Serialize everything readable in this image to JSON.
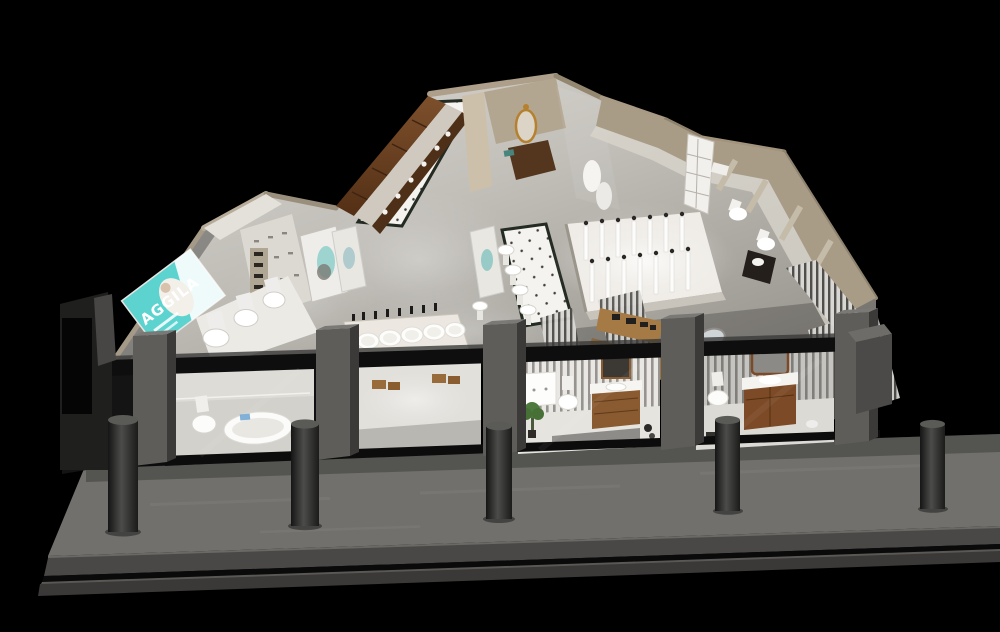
{
  "scene": {
    "title": "Sanitary-ware showroom - aerial cutaway 3D render",
    "style": "night render on black surround, bird's-eye isometric view",
    "background_color": "#000000"
  },
  "billboard": {
    "brand": "AGGILA",
    "panel_color": "#5dd3d0",
    "text_color": "#ffffff",
    "location": "left showroom wall lightbox"
  },
  "zones": [
    {
      "id": "wood-cabinet-wall",
      "label": "dark wood cabinet display wall"
    },
    {
      "id": "dotted-tile-walkway",
      "label": "white dotted tile walkway with dark green border"
    },
    {
      "id": "toilet-display-row-left",
      "label": "toilet display row on white plinth",
      "fixture_count": 3
    },
    {
      "id": "faucet-display-shelving",
      "label": "white faucet display shelving with lightbox"
    },
    {
      "id": "basin-display-table",
      "label": "illuminated countertop basin table",
      "basin_count": 5
    },
    {
      "id": "pedestal-basin-row",
      "label": "pedestal basins along walkway",
      "fixture_count": 5
    },
    {
      "id": "shower-fixture-display",
      "label": "brightly lit shower column display",
      "column_count": 14
    },
    {
      "id": "luxury-vanity-vignette",
      "label": "classic vanity vignette with ornate gold mirror"
    },
    {
      "id": "right-wall-bath-vignettes",
      "label": "bathroom vignettes along right wall",
      "toilet_count": 3
    },
    {
      "id": "slat-partition-area",
      "label": "timber-slat partition displays with round mirror and dark cabinet"
    }
  ],
  "storefront": {
    "pier_count": 5,
    "bollard_count": 5,
    "step_count": 2,
    "glass_vignettes": [
      {
        "id": "vignette-tub",
        "contents": [
          "toilet",
          "bathtub",
          "round side table"
        ]
      },
      {
        "id": "vignette-stools",
        "contents": [
          "open floor",
          "wood stools"
        ]
      },
      {
        "id": "vignette-vanity",
        "contents": [
          "white cabinet",
          "toilet",
          "wood vanity with mirror",
          "potted plant"
        ]
      },
      {
        "id": "vignette-wood-vanity",
        "contents": [
          "toilet",
          "wood vanity with arched mirror"
        ]
      }
    ]
  },
  "palette": {
    "background": "#000000",
    "floor": "#c9c6c0",
    "floor_bright": "#efeeea",
    "walls_beige": "#a99c87",
    "wood": "#6e4524",
    "accent_teal": "#5dd3d0",
    "storefront_frame": "#0e0e0e",
    "pier_gray": "#5f5d5a",
    "sidewalk": "#71706d",
    "step": "#4a4846",
    "bollard": "#2e2e2d"
  }
}
